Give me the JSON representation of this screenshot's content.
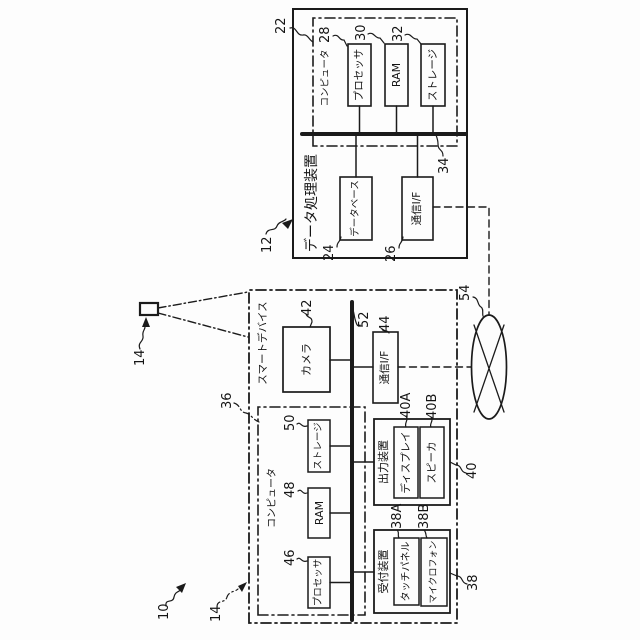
{
  "diagram": {
    "system": {
      "ref": "10"
    },
    "external_camera": {
      "ref": "14"
    },
    "network": {
      "ref": "54"
    },
    "smart_device": {
      "ref": "14",
      "label": "スマートデバイス",
      "camera": {
        "ref": "42",
        "label": "カメラ"
      },
      "bus": {
        "ref": "52"
      },
      "comm_if": {
        "ref": "44",
        "label": "通信I/F"
      },
      "computer": {
        "ref": "36",
        "label": "コンピュータ",
        "processor": {
          "ref": "46",
          "label": "プロセッサ"
        },
        "ram": {
          "ref": "48",
          "label": "RAM"
        },
        "storage": {
          "ref": "50",
          "label": "ストレージ"
        }
      },
      "output_device": {
        "ref": "40",
        "label": "出力装置",
        "display": {
          "ref": "40A",
          "label": "ディスプレイ"
        },
        "speaker": {
          "ref": "40B",
          "label": "スピーカ"
        }
      },
      "reception_device": {
        "ref": "38",
        "label": "受付装置",
        "touch_panel": {
          "ref": "38A",
          "label": "タッチパネル"
        },
        "microphone": {
          "ref": "38B",
          "label": "マイクロフォン"
        }
      }
    },
    "data_processing_device": {
      "ref": "12",
      "label": "データ処理装置",
      "computer": {
        "ref": "22",
        "label": "コンピュータ",
        "processor": {
          "ref": "28",
          "label": "プロセッサ"
        },
        "ram": {
          "ref": "30",
          "label": "RAM"
        },
        "storage": {
          "ref": "32",
          "label": "ストレージ"
        }
      },
      "bus": {
        "ref": "34"
      },
      "database": {
        "ref": "24",
        "label": "データベース"
      },
      "comm_if": {
        "ref": "26",
        "label": "通信I/F"
      }
    }
  }
}
